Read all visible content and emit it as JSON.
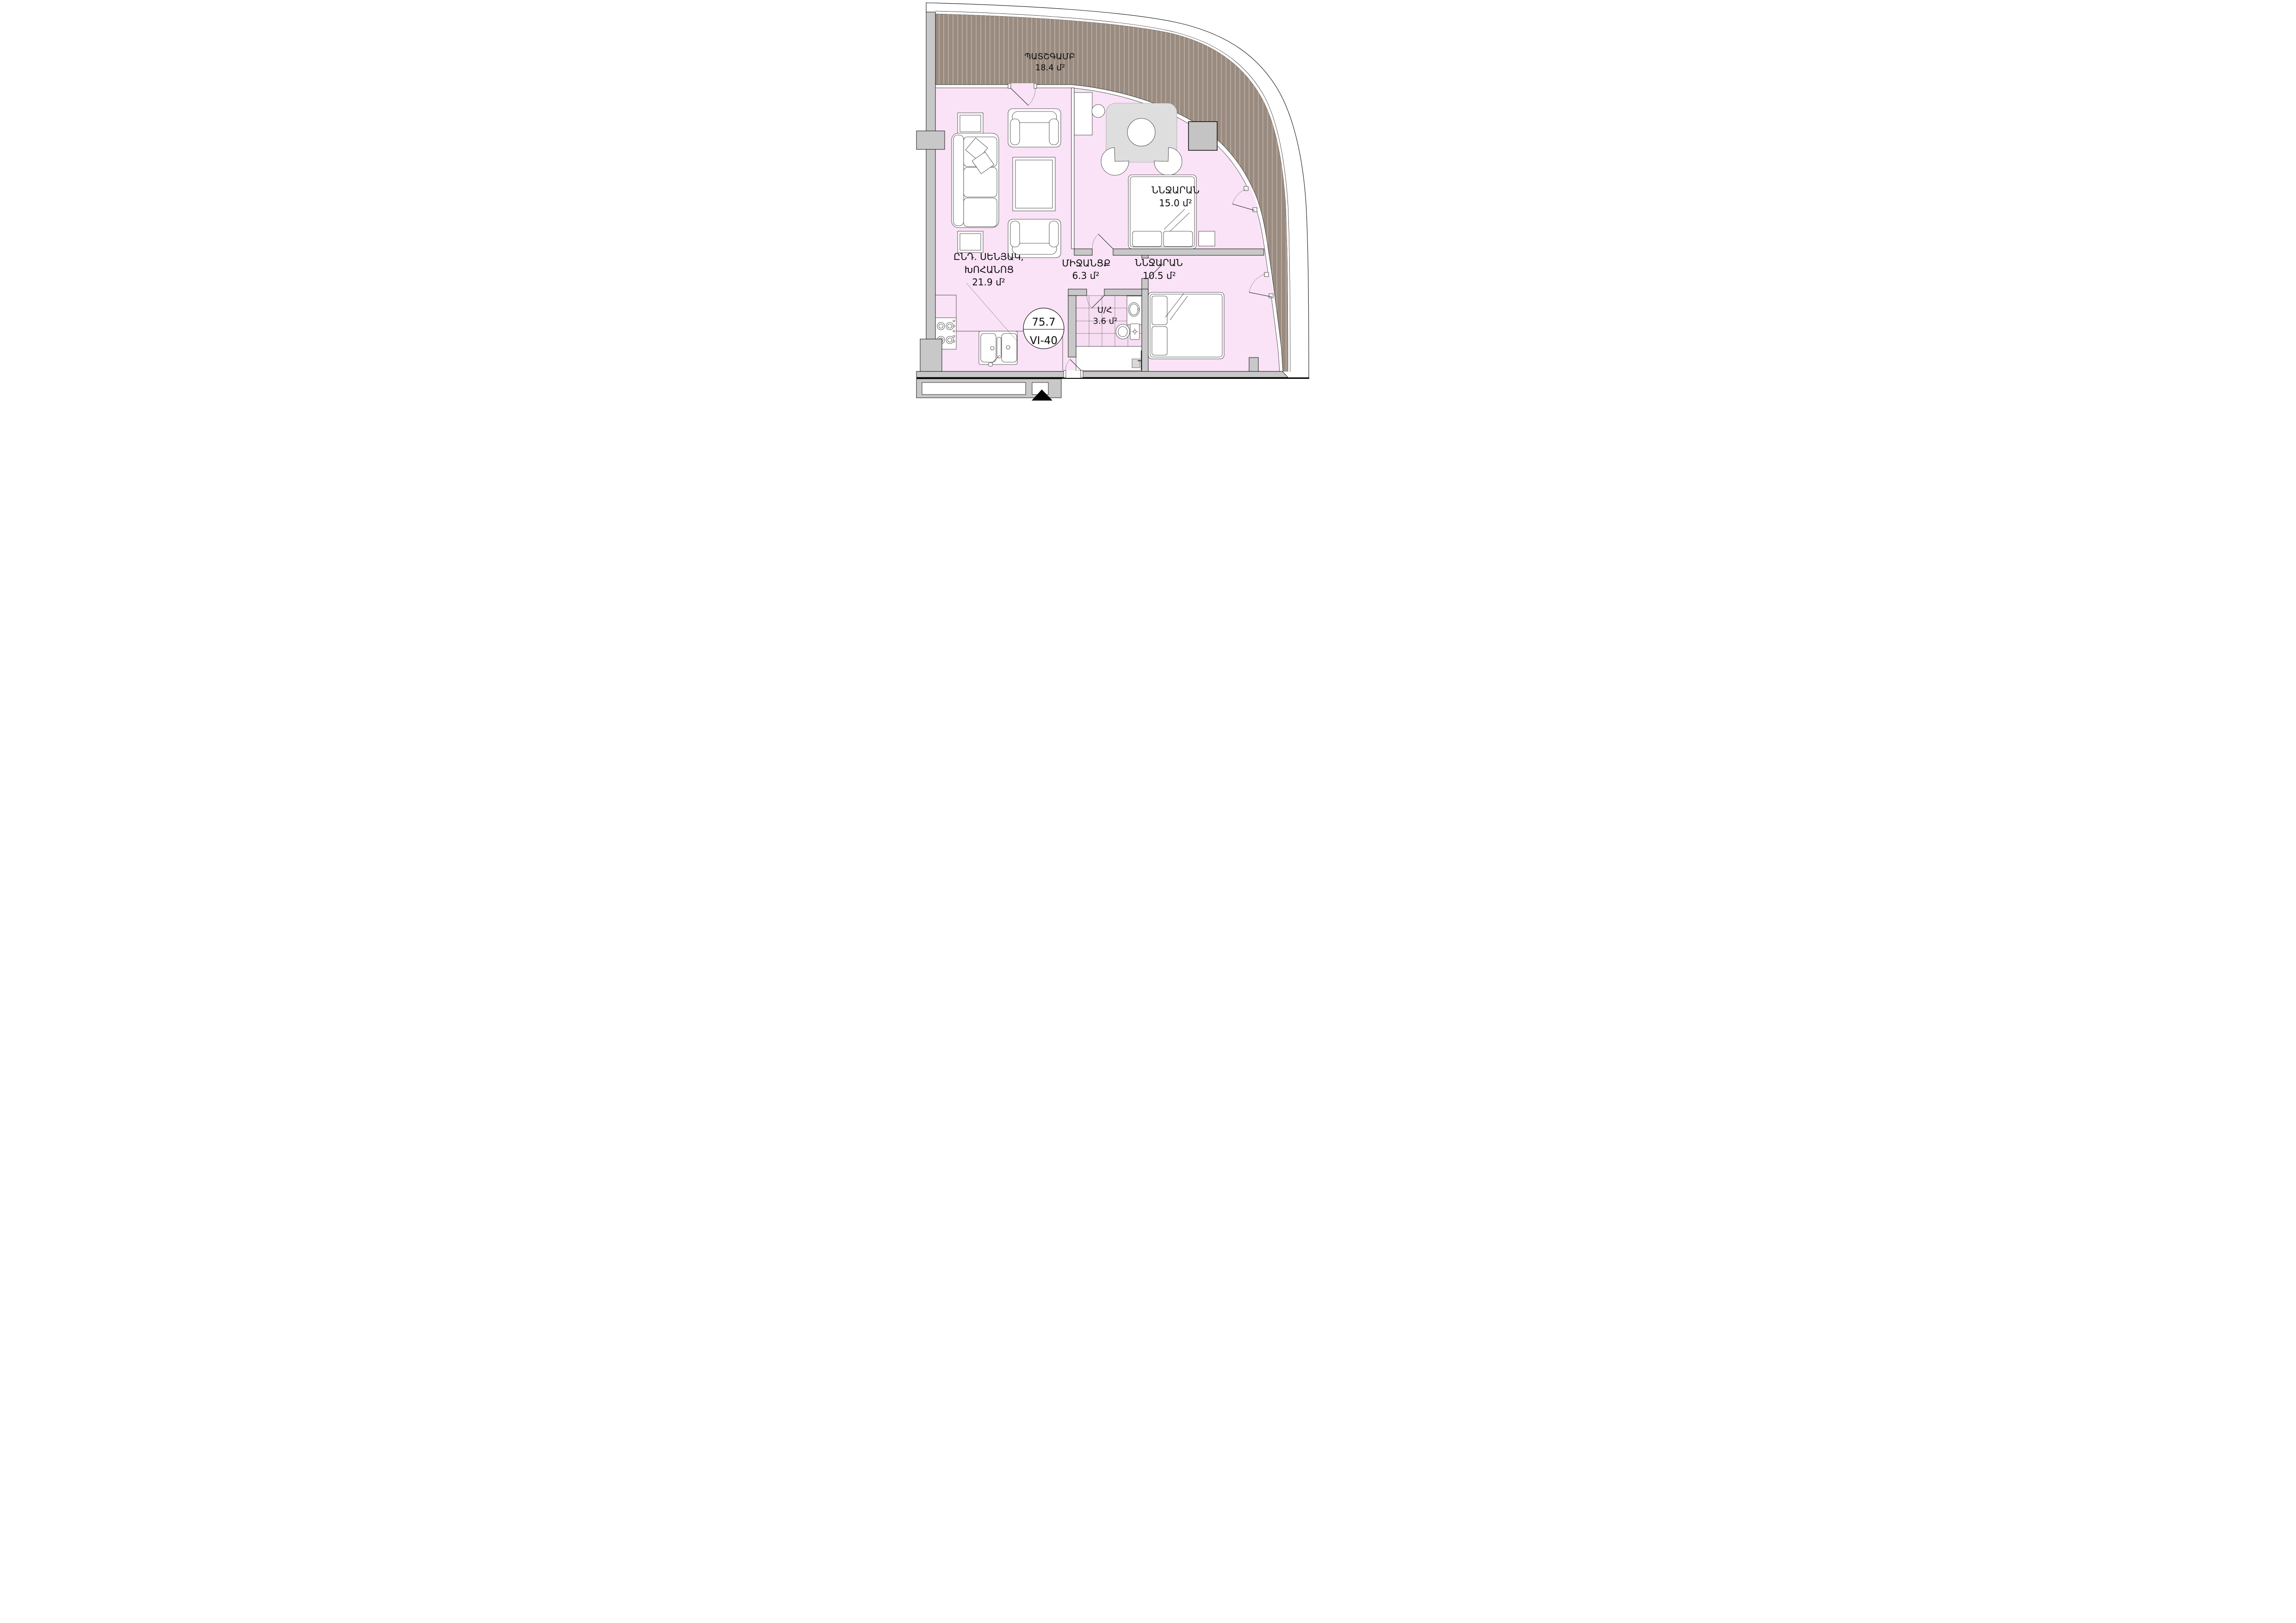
{
  "title": "Apartment floor plan VI-40",
  "badge": {
    "area_value": "75.7",
    "unit_number": "VI-40"
  },
  "rooms": {
    "balcony": {
      "name": "ՊԱՏՇԳԱՄԲ",
      "area": "18.4 մ²"
    },
    "living": {
      "name_line1": "ԸՆԴ. ՍԵՆՅԱԿ,",
      "name_line2": "ԽՈՀԱՆՈՑ",
      "area": "21.9 մ²"
    },
    "bedroom1": {
      "name": "ՆՆՋԱՐԱՆ",
      "area": "15.0 մ²"
    },
    "corridor": {
      "name": "ՄԻՋԱՆՑՔ",
      "area": "6.3 մ²"
    },
    "bedroom2": {
      "name": "ՆՆՋԱՐԱՆ",
      "area": "10.5 մ²"
    },
    "bathroom": {
      "name": "Ս/Հ",
      "area": "3.6 մ²"
    }
  },
  "colors": {
    "floor_pink": "#fae3f6",
    "balcony_brown": "#9a8b80",
    "balcony_hatch": "#cdc3ba",
    "wall_gray": "#c8c8c8",
    "rug_gray": "#dedede",
    "cabinet_gray": "#c4c4c4",
    "line_black": "#1a1a1a"
  }
}
